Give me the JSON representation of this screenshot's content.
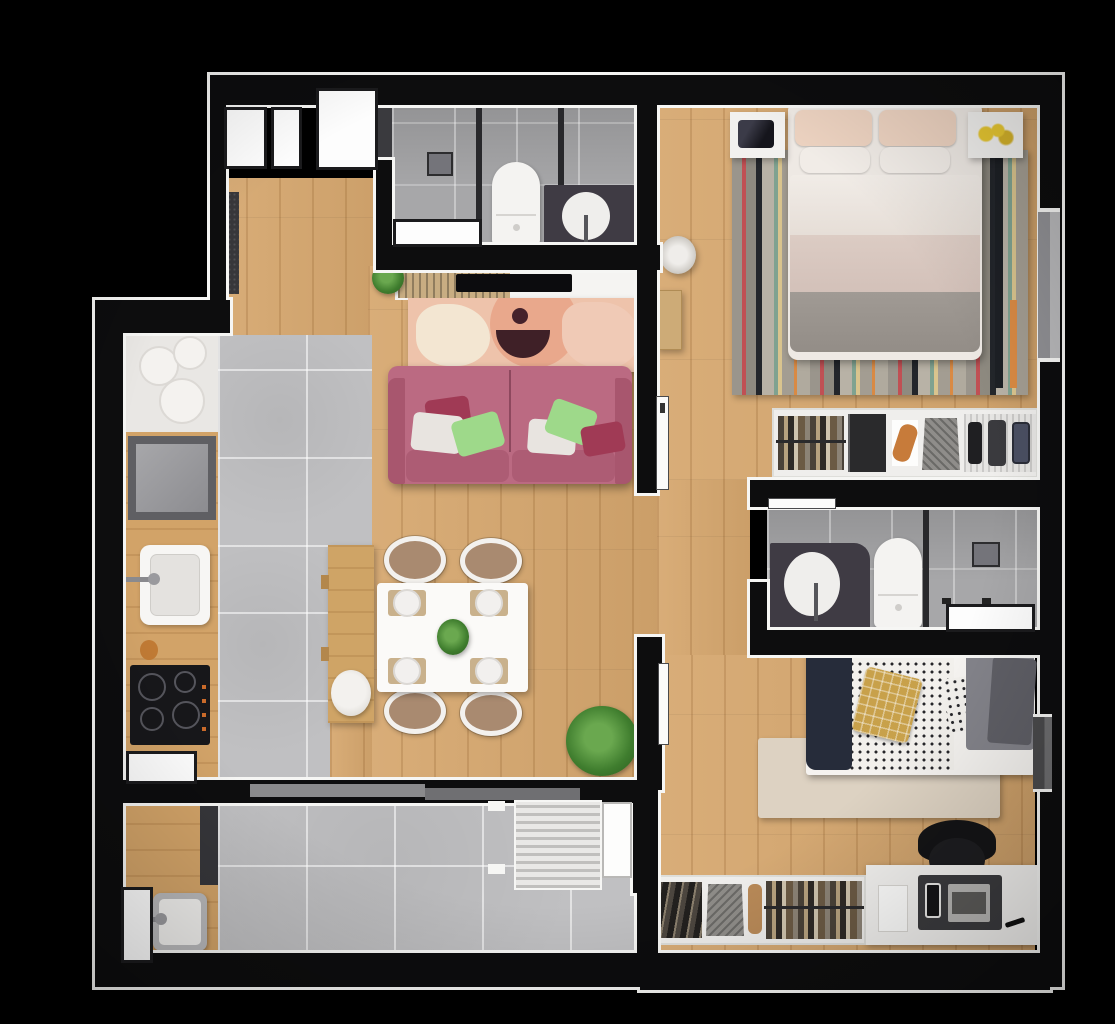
{
  "title": "apartment-floor-plan-top-view",
  "canvas": {
    "width": 1115,
    "height": 1024,
    "background": "#000000"
  },
  "palette": {
    "wall": "#0d0d0e",
    "wall_outline": "#f6f6f4",
    "wood_floor": "#d6a76e",
    "kitchen_tile": "#c0c0c2",
    "bathroom_tile": "#a7a7a9",
    "sofa_pink": "#b5657c",
    "living_rug_peach": "#eec3ab",
    "rug_accent_dark": "#3f2027",
    "green_pillow": "#9ed98a",
    "master_duvet_gray": "#9a948e",
    "master_pillow_blush": "#ecd2c0",
    "mustard_pillow": "#c8a14b",
    "navy_throw": "#262c3a",
    "bedroom2_rug": "#ddd2c2",
    "desk_white": "#f2f1ef",
    "chair_black": "#161618",
    "vanity_dark": "#3f3b44",
    "fixture_white": "#f4f3f1",
    "plant_green": "#3f7d2e",
    "cooktop_black": "#17171a",
    "stool_white": "#e9e6e2",
    "window_glass_gray": "#909094"
  },
  "rooms": [
    {
      "name": "entry-hall",
      "items": [
        "entry-door",
        "window",
        "window",
        "doormat"
      ]
    },
    {
      "name": "bathroom-1",
      "items": [
        "shower-partition",
        "shower-head",
        "toilet",
        "vanity-basin",
        "wall-niche"
      ]
    },
    {
      "name": "master-bedroom",
      "items": [
        "double-bed",
        "pillows",
        "nightstand-left",
        "nightstand-right",
        "striped-rug",
        "wardrobe-clothes-rack",
        "side-window"
      ]
    },
    {
      "name": "hallway",
      "items": [
        "pouf",
        "console",
        "door-leaf"
      ]
    },
    {
      "name": "living-room",
      "items": [
        "pink-sofa",
        "throw-pillows",
        "abstract-rug",
        "tv",
        "tv-console",
        "slatted-sideboard",
        "plant"
      ]
    },
    {
      "name": "dining-area",
      "items": [
        "dining-table",
        "four-chairs",
        "place-settings",
        "centerpiece",
        "island-bench",
        "stool",
        "floor-plant"
      ]
    },
    {
      "name": "kitchen",
      "items": [
        "counter",
        "plates",
        "square-appliance",
        "sink",
        "cooktop",
        "pass-window"
      ]
    },
    {
      "name": "bathroom-2",
      "items": [
        "vanity-basin",
        "toilet",
        "shower-partition",
        "shower-head",
        "window",
        "door-leaf"
      ]
    },
    {
      "name": "bedroom-2",
      "items": [
        "single-bed",
        "mustard-pillow",
        "patterned-duvet",
        "rug",
        "desk",
        "laptop",
        "office-chair",
        "wardrobe-clothes-rack",
        "side-window"
      ]
    },
    {
      "name": "laundry-service",
      "items": [
        "counter",
        "tub-sink",
        "washer",
        "louver-window",
        "window",
        "sliding-door-wall"
      ]
    }
  ]
}
